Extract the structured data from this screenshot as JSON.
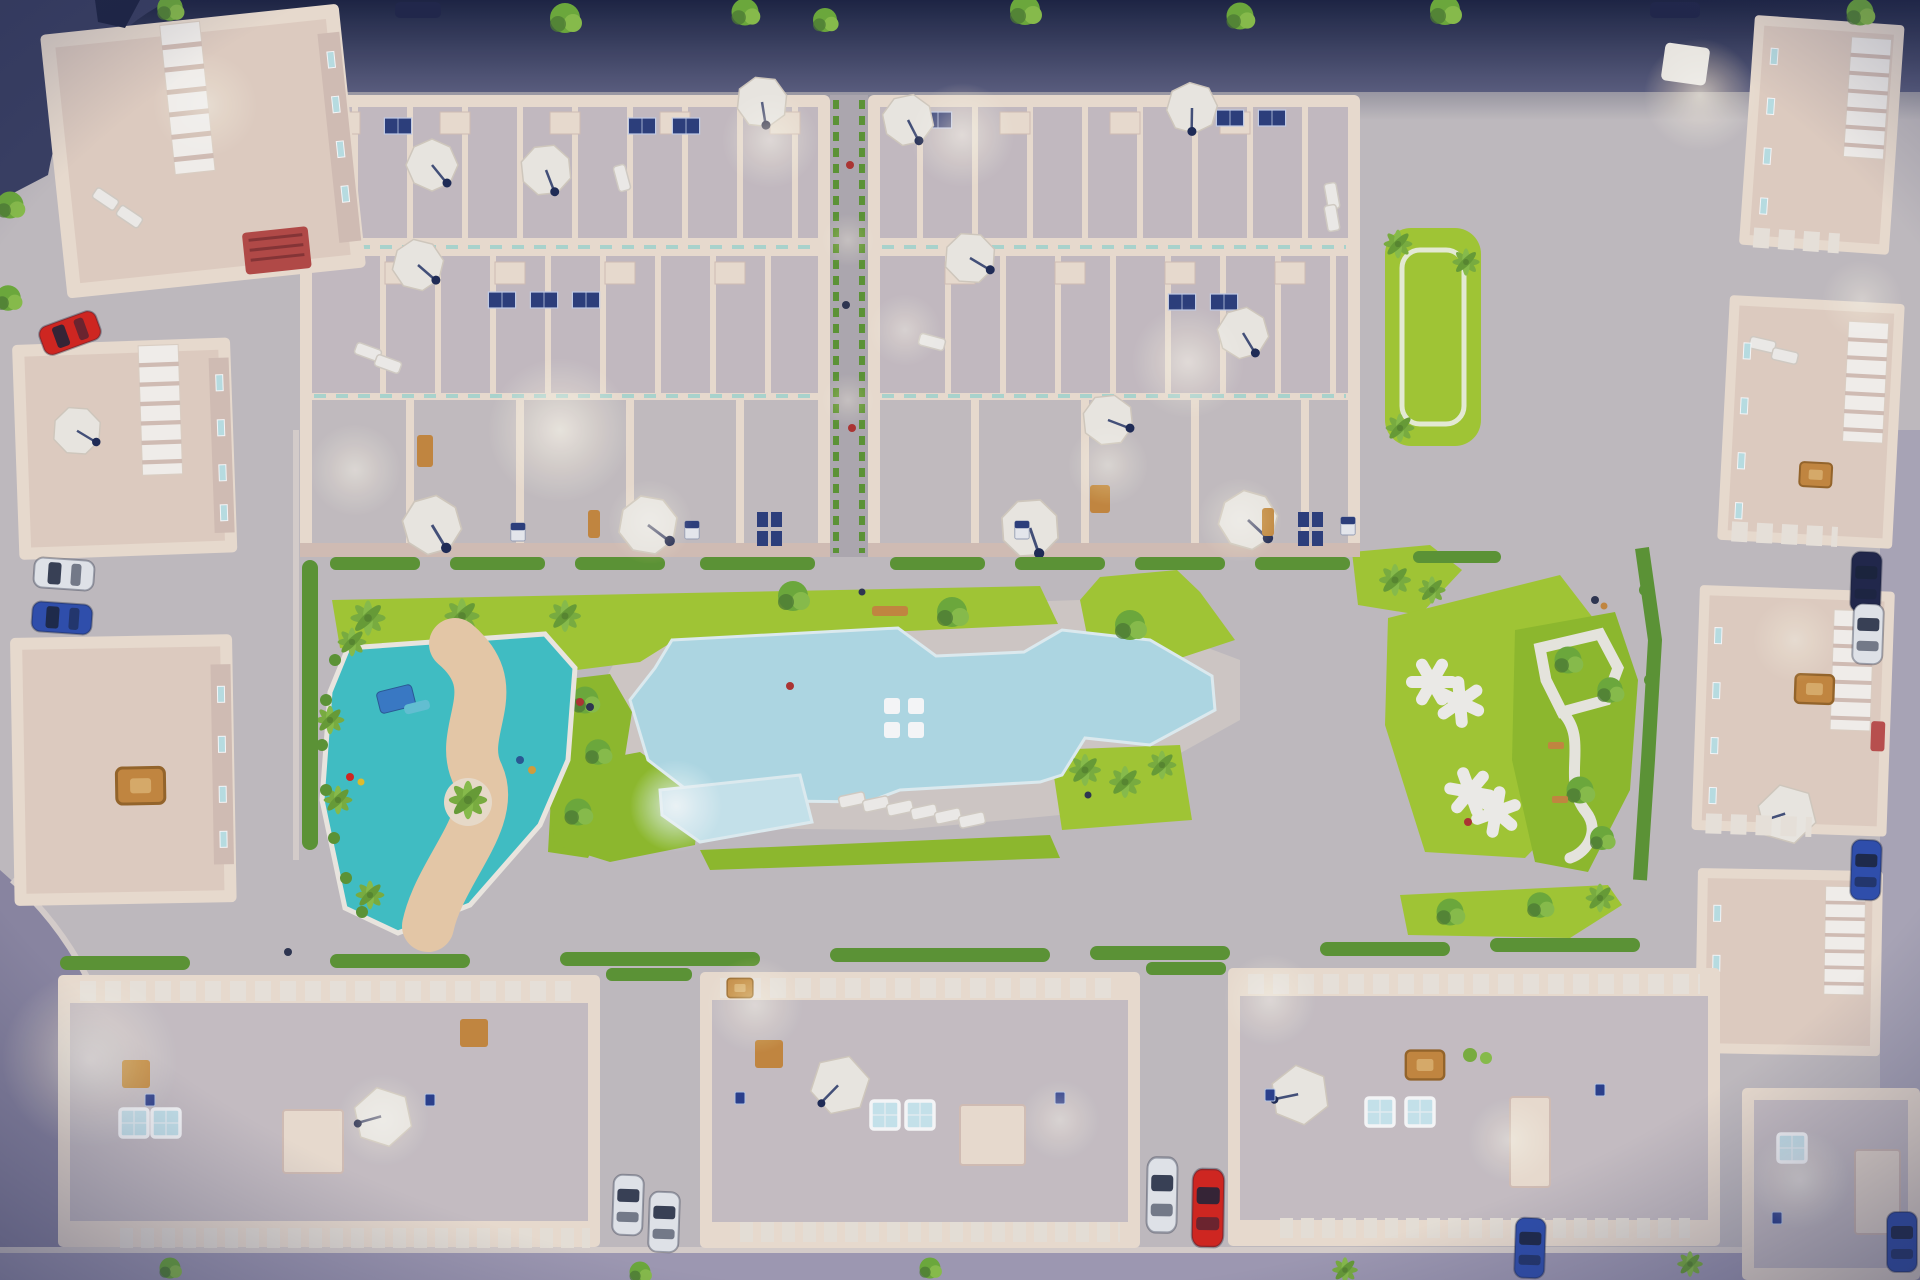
{
  "scene": {
    "description": "Dusk aerial top-down 3D render of a gated residential complex: two large townhouse blocks with lit rooftop terraces at top, apartment buildings left and right, three long apartment blocks at bottom, central garden with large free-form swimming pool, glowing children's pool, sunbathing deck, teal splash playground with winding sand river, lawns with white shade pergolas, hedges, palm trees and parked cars",
    "view": "top-down aerial",
    "time_of_day": "dusk with warm rooftop and street lighting"
  },
  "palette": {
    "night_sky": "#1c2342",
    "road_top": "#6f7092",
    "pavement": "#c6c0c3",
    "pavement_warm": "#d6cec9",
    "road_lavender": "#a39db6",
    "road_left": "#8e89a4",
    "sidewalk": "#ded4d0",
    "lawn": "#a6cd32",
    "lawn_dark": "#92bf2b",
    "hedge": "#5e9733",
    "tree": "#6fae3a",
    "tree_dark": "#4e7c33",
    "palm": "#7db23e",
    "pool": "#b4dfe9",
    "pool_light": "#cdeaf2",
    "playground_teal": "#41c4c8",
    "playground_sand": "#eecfab",
    "sand_light": "#f2e3cf",
    "wall_cream": "#f2e3d4",
    "wall_shadow": "#d9c3b8",
    "roof_pink": "#e7d3c5",
    "roof_terrace": "#cac0c5",
    "patio_gray": "#c9c2c4",
    "cobble": "#b3adb3",
    "off_white": "#f3efe7",
    "glass_teal": "#9fd8d2",
    "window_cyan": "#bfe5e8",
    "panel_navy": "#2c3e7d",
    "door_navy": "#2a3f8f",
    "car_red": "#d8251d",
    "car_blue": "#2f4fb0",
    "car_white": "#e9ebf0",
    "car_dark": "#20264a",
    "wood_tan": "#c98a3e",
    "rug_red": "#b84a46",
    "glow_warm": "#ffe9b4",
    "glow_cool": "#eafcff",
    "vignette": "#262c52"
  },
  "inventory": {
    "amenities": [
      "main-swimming-pool",
      "children-splash-pool",
      "sun-lounger-deck",
      "splash-playground-lazy-river",
      "pergola-lawn-park",
      "winding-path-garden",
      "petanque-lawn-strip",
      "paseo-walkway",
      "hedge-planters",
      "palm-trees"
    ],
    "building_groups": [
      "top-left-apartments",
      "left-apartments",
      "townhouse-block-west",
      "townhouse-block-east",
      "right-apartment-row",
      "bottom-block-west",
      "bottom-block-center",
      "bottom-block-east",
      "bottom-right-corner-building"
    ],
    "rooftop_features": [
      "white-octagonal-parasols",
      "hexagonal-parasols",
      "sun-loungers",
      "jacuzzi-skylights",
      "solar-panels",
      "wooden-dining-sets",
      "stair-bulkheads",
      "balcony-railings",
      "pergola-slats"
    ],
    "vehicle_counts": {
      "red": 2,
      "blue": 4,
      "white": 4,
      "dark": 3,
      "white_van": 1
    },
    "people_visible": 12,
    "lit_lamps_glows": 22
  }
}
